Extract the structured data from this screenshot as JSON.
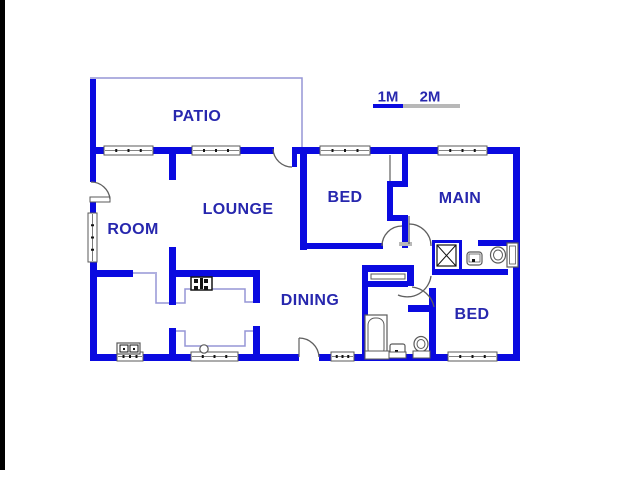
{
  "colors": {
    "wall": "#0a0ae0",
    "label": "#2727ae",
    "thin": "#9595d6",
    "door": "#5f5f5f",
    "frame": "#5a5a5a",
    "dark": "#141414",
    "gray": "#b8b8b8",
    "white": "#ffffff",
    "edge": "#000000"
  },
  "rooms": [
    {
      "label": "PATIO",
      "x": 197,
      "y": 117
    },
    {
      "label": "LOUNGE",
      "x": 238,
      "y": 210
    },
    {
      "label": "ROOM",
      "x": 133,
      "y": 230
    },
    {
      "label": "BED",
      "x": 345,
      "y": 198
    },
    {
      "label": "MAIN",
      "x": 460,
      "y": 199
    },
    {
      "label": "DINING",
      "x": 310,
      "y": 301
    },
    {
      "label": "BED",
      "x": 472,
      "y": 315
    }
  ],
  "scale": {
    "marks": [
      {
        "label": "1M",
        "x": 388,
        "y": 97
      },
      {
        "label": "2M",
        "x": 430,
        "y": 97
      }
    ],
    "bar_blue": [
      373,
      104,
      30,
      4
    ],
    "bar_gray": [
      403,
      104,
      57,
      4
    ]
  },
  "plan": {
    "edge_strip": [
      0,
      0,
      5,
      470
    ],
    "walls": [
      [
        90,
        79,
        6,
        69
      ],
      [
        90,
        147,
        14,
        7
      ],
      [
        153,
        147,
        39,
        7
      ],
      [
        240,
        147,
        34,
        7
      ],
      [
        297,
        147,
        23,
        7
      ],
      [
        370,
        147,
        68,
        7
      ],
      [
        487,
        147,
        32,
        7
      ],
      [
        513,
        147,
        7,
        214
      ],
      [
        90,
        147,
        6,
        35
      ],
      [
        90,
        200,
        6,
        14
      ],
      [
        90,
        261,
        7,
        100
      ],
      [
        90,
        354,
        209,
        7
      ],
      [
        319,
        354,
        129,
        7
      ],
      [
        497,
        354,
        22,
        7
      ],
      [
        169,
        154,
        7,
        26
      ],
      [
        169,
        247,
        7,
        58
      ],
      [
        92,
        270,
        41,
        7
      ],
      [
        176,
        270,
        82,
        7
      ],
      [
        253,
        270,
        7,
        33
      ],
      [
        253,
        326,
        7,
        32
      ],
      [
        169,
        328,
        7,
        30
      ],
      [
        300,
        147,
        7,
        103
      ],
      [
        300,
        243,
        83,
        6
      ],
      [
        402,
        154,
        6,
        31
      ],
      [
        387,
        181,
        21,
        6
      ],
      [
        387,
        181,
        6,
        40
      ],
      [
        387,
        215,
        21,
        6
      ],
      [
        402,
        215,
        6,
        33
      ],
      [
        478,
        240,
        41,
        6
      ],
      [
        432,
        269,
        76,
        6
      ],
      [
        367,
        265,
        47,
        7
      ],
      [
        367,
        281,
        41,
        6
      ],
      [
        407,
        272,
        7,
        14
      ],
      [
        362,
        265,
        6,
        96
      ],
      [
        429,
        288,
        7,
        73
      ],
      [
        408,
        305,
        28,
        7
      ],
      [
        292,
        147,
        5,
        20
      ]
    ],
    "thin_paths": [
      "M90,78 L302,78 L302,147",
      "M133,273 L157,273",
      "M156,274 L156,303 L169,303",
      "M176,303 L185,303 L185,289 L245,289 L245,302 L253,302",
      "M176,331 L185,331 L185,346 L245,346 L245,331 L253,331"
    ],
    "windows": [
      [
        104,
        146,
        49,
        9,
        0
      ],
      [
        192,
        146,
        48,
        9,
        0
      ],
      [
        320,
        146,
        50,
        9,
        0
      ],
      [
        438,
        146,
        49,
        9,
        0
      ],
      [
        88,
        213,
        9,
        49,
        1
      ],
      [
        117,
        352,
        26,
        9,
        0
      ],
      [
        191,
        352,
        47,
        9,
        0
      ],
      [
        331,
        352,
        23,
        9,
        0
      ],
      [
        448,
        352,
        49,
        9,
        0
      ]
    ],
    "gray_lines": [
      "M390,155 L390,181",
      "M409,216 L409,244",
      "M299,338 L299,357"
    ],
    "door_arcs": [
      "M91,182 A19,19 0 0 1 110,199",
      "M273,149 A19,19 0 0 0 292,167",
      "M382,246 A20,20 0 0 1 402,226",
      "M409,224 A22,22 0 0 1 431,246",
      "M299,338 A20,20 0 0 1 319,357",
      "M412,287 A25,25 0 0 1 434,307",
      "M431,276 A24,24 0 0 1 398,295"
    ],
    "fixtures": [
      {
        "k": "rect",
        "x": 371,
        "y": 274,
        "w": 34,
        "h": 5,
        "st": "frame",
        "f": "white",
        "sw": 1,
        "n": "linen-closet"
      },
      {
        "k": "rect",
        "x": 90,
        "y": 197,
        "w": 20,
        "h": 5,
        "st": "frame",
        "f": "white",
        "sw": 1,
        "n": "door-leaf"
      },
      {
        "k": "rect",
        "x": 399,
        "y": 242,
        "w": 13,
        "h": 4,
        "f": "gray",
        "n": "door-hinge"
      },
      {
        "k": "rect",
        "x": 191,
        "y": 277,
        "w": 21,
        "h": 13,
        "st": "dark",
        "f": "white",
        "sw": 1.5,
        "n": "stove-icon"
      },
      {
        "k": "rect",
        "x": 194,
        "y": 279,
        "w": 4,
        "h": 4,
        "f": "dark",
        "n": "stove-burner"
      },
      {
        "k": "rect",
        "x": 204,
        "y": 279,
        "w": 4,
        "h": 4,
        "f": "dark",
        "n": "stove-burner"
      },
      {
        "k": "rect",
        "x": 194,
        "y": 286,
        "w": 4,
        "h": 4,
        "f": "dark",
        "n": "stove-burner"
      },
      {
        "k": "rect",
        "x": 204,
        "y": 286,
        "w": 4,
        "h": 4,
        "f": "dark",
        "n": "stove-burner"
      },
      {
        "k": "rect",
        "x": 200,
        "y": 278,
        "w": 3,
        "h": 11,
        "f": "dark",
        "n": "stove-center"
      },
      {
        "k": "circle",
        "cx": 204,
        "cy": 349,
        "r": 4.2,
        "st": "frame",
        "f": "white",
        "sw": 1.2,
        "n": "kitchen-sink-icon"
      },
      {
        "k": "rect",
        "x": 117,
        "y": 343,
        "w": 23,
        "h": 11,
        "st": "frame",
        "f": "white",
        "sw": 1.2,
        "n": "double-sink-icon"
      },
      {
        "k": "rect",
        "x": 120,
        "y": 345,
        "w": 8,
        "h": 7,
        "st": "dark",
        "f": "white",
        "sw": 1,
        "n": "sink-bowl"
      },
      {
        "k": "rect",
        "x": 130,
        "y": 345,
        "w": 8,
        "h": 7,
        "st": "dark",
        "f": "white",
        "sw": 1,
        "n": "sink-bowl"
      },
      {
        "k": "rect",
        "x": 123,
        "y": 348,
        "w": 2,
        "h": 2,
        "f": "dark",
        "n": "sink-drain"
      },
      {
        "k": "rect",
        "x": 133,
        "y": 348,
        "w": 2,
        "h": 2,
        "f": "dark",
        "n": "sink-drain"
      },
      {
        "k": "rect",
        "x": 365,
        "y": 315,
        "w": 22,
        "h": 44,
        "st": "frame",
        "f": "white",
        "sw": 1.2,
        "n": "bathtub-icon"
      },
      {
        "k": "rect",
        "x": 368,
        "y": 318,
        "w": 16,
        "h": 38,
        "rx": 7,
        "st": "frame",
        "f": "white",
        "sw": 1,
        "n": "bathtub-basin"
      },
      {
        "k": "rect",
        "x": 365,
        "y": 351,
        "w": 24,
        "h": 8,
        "st": "frame",
        "f": "white",
        "sw": 1,
        "n": "bathtub-base"
      },
      {
        "k": "rect",
        "x": 390,
        "y": 344,
        "w": 15,
        "h": 12,
        "rx": 2,
        "st": "frame",
        "f": "white",
        "sw": 1.2,
        "n": "vanity-icon"
      },
      {
        "k": "rect",
        "x": 395,
        "y": 350,
        "w": 3,
        "h": 3,
        "f": "dark",
        "n": "vanity-drain"
      },
      {
        "k": "rect",
        "x": 389,
        "y": 352,
        "w": 17,
        "h": 6,
        "st": "frame",
        "f": "white",
        "sw": 1,
        "n": "vanity-base"
      },
      {
        "k": "ellipse",
        "cx": 421,
        "cy": 344,
        "rx": 7,
        "ry": 7.5,
        "st": "frame",
        "f": "white",
        "sw": 1.2,
        "n": "toilet-icon"
      },
      {
        "k": "ellipse",
        "cx": 421,
        "cy": 344,
        "rx": 4,
        "ry": 4.5,
        "st": "frame",
        "f": "none",
        "sw": 1,
        "n": "toilet-bowl"
      },
      {
        "k": "rect",
        "x": 413,
        "y": 351,
        "w": 17,
        "h": 7,
        "st": "frame",
        "f": "white",
        "sw": 1,
        "n": "toilet-base"
      },
      {
        "k": "rect",
        "x": 467,
        "y": 252,
        "w": 15,
        "h": 13,
        "rx": 3,
        "st": "frame",
        "f": "white",
        "sw": 1.2,
        "n": "basin-icon"
      },
      {
        "k": "rect",
        "x": 469,
        "y": 254,
        "w": 11,
        "h": 8,
        "st": "frame",
        "f": "none",
        "sw": 0.8,
        "n": "basin-bowl"
      },
      {
        "k": "rect",
        "x": 472,
        "y": 259,
        "w": 3,
        "h": 3,
        "f": "dark",
        "n": "basin-drain"
      },
      {
        "k": "rect",
        "x": 507,
        "y": 243,
        "w": 11,
        "h": 24,
        "st": "frame",
        "f": "white",
        "sw": 1.2,
        "n": "toilet-tank"
      },
      {
        "k": "rect",
        "x": 509.5,
        "y": 246,
        "w": 6,
        "h": 18,
        "st": "frame",
        "f": "none",
        "sw": 0.8,
        "n": "toilet-tank-inner"
      },
      {
        "k": "ellipse",
        "cx": 498,
        "cy": 255,
        "rx": 7.5,
        "ry": 8,
        "st": "frame",
        "f": "white",
        "sw": 1.2,
        "n": "toilet-icon"
      },
      {
        "k": "ellipse",
        "cx": 498,
        "cy": 255,
        "rx": 4.5,
        "ry": 5,
        "st": "frame",
        "f": "none",
        "sw": 1,
        "n": "toilet-bowl"
      },
      {
        "k": "rect",
        "x": 433.5,
        "y": 241.5,
        "w": 27,
        "h": 30,
        "st": "wall",
        "f": "none",
        "sw": 3,
        "n": "shower-enclosure"
      },
      {
        "k": "rect",
        "x": 437,
        "y": 245,
        "w": 19,
        "h": 21,
        "st": "dark",
        "f": "white",
        "sw": 1.2,
        "n": "shower-tray"
      },
      {
        "k": "path",
        "d": "M437,245 L456,266",
        "st": "dark",
        "sw": 1,
        "n": "shower-cross"
      },
      {
        "k": "path",
        "d": "M456,245 L437,266",
        "st": "dark",
        "sw": 1,
        "n": "shower-cross"
      }
    ]
  }
}
